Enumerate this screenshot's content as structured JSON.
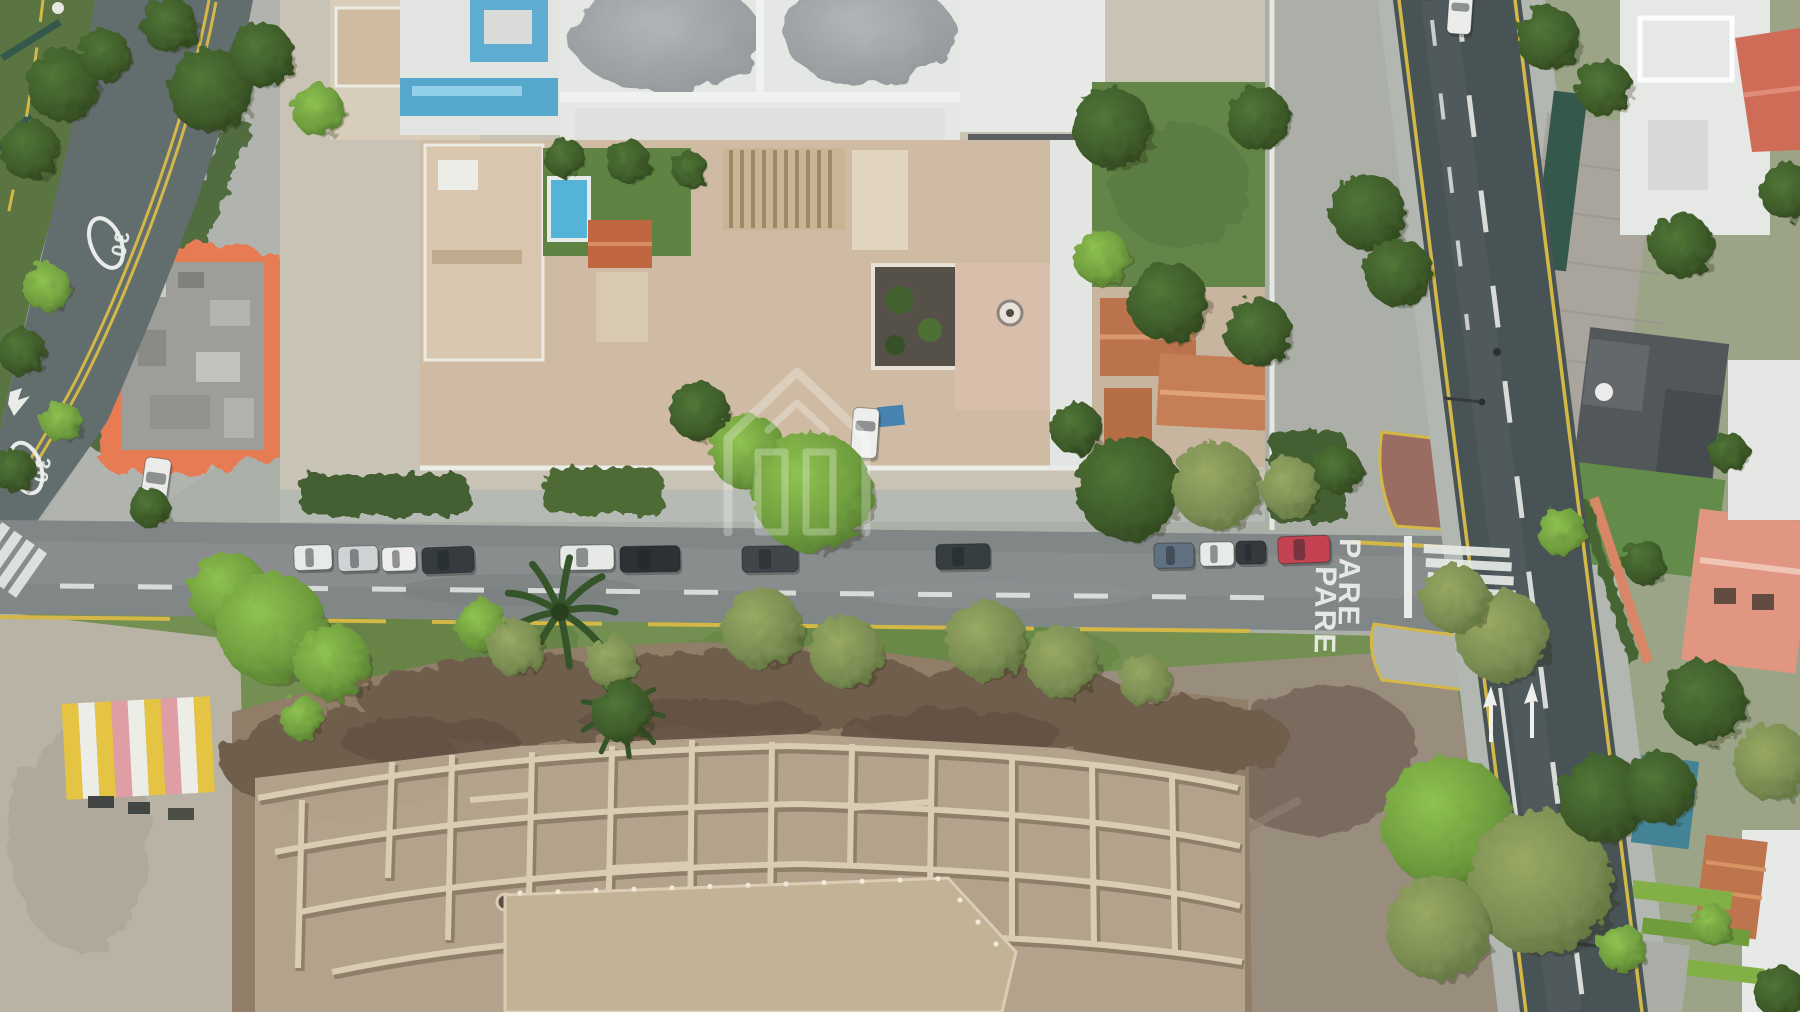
{
  "image": {
    "type": "aerial-drone-photo",
    "subject": "top-down city block with streets, houses, gardens and an excavated archaeological mound"
  },
  "road_markings": {
    "stop_text": "PARE",
    "speed_limit_text": "30"
  },
  "watermark": {
    "icon": "house-logo",
    "color": "#ffffff"
  },
  "palette": {
    "asphalt_dark": "#414c4e",
    "asphalt_mid": "#7d8283",
    "asphalt_blue": "#5c6869",
    "sidewalk": "#b2b6b0",
    "curb_yellow": "#d4b740",
    "marking_white": "#e9ece9",
    "building_orange": "#e0714a",
    "building_blue": "#4fa5cc",
    "roof_beige": "#cfbaa1",
    "roof_terracotta": "#b96e46",
    "lawn_green": "#5d8140",
    "tree_dark": "#2f4f22",
    "tree_bright": "#6fa03a",
    "tree_olive": "#768a4c",
    "huaca_dark": "#6a5845",
    "huaca_light": "#b2a189",
    "plaza": "#b7b1a3",
    "dirt_field": "#96897a",
    "pool_blue": "#4fb2d8"
  },
  "parked_cars": [
    {
      "x": 294,
      "y": 545,
      "w": 38,
      "h": 25,
      "angle": -2,
      "color": "#e9ebe8"
    },
    {
      "x": 338,
      "y": 546,
      "w": 40,
      "h": 25,
      "angle": -2,
      "color": "#ced3d4"
    },
    {
      "x": 382,
      "y": 547,
      "w": 34,
      "h": 24,
      "angle": -2,
      "color": "#f0f1ef"
    },
    {
      "x": 422,
      "y": 547,
      "w": 52,
      "h": 26,
      "angle": -2,
      "color": "#2d3336"
    },
    {
      "x": 560,
      "y": 545,
      "w": 54,
      "h": 25,
      "angle": -1,
      "color": "#e8eae7"
    },
    {
      "x": 620,
      "y": 546,
      "w": 60,
      "h": 26,
      "angle": -1,
      "color": "#24292c"
    },
    {
      "x": 742,
      "y": 546,
      "w": 56,
      "h": 26,
      "angle": -1,
      "color": "#383f42"
    },
    {
      "x": 936,
      "y": 544,
      "w": 54,
      "h": 25,
      "angle": -1,
      "color": "#2f3639"
    },
    {
      "x": 1154,
      "y": 543,
      "w": 40,
      "h": 25,
      "angle": -1,
      "color": "#5a6c7e"
    },
    {
      "x": 1200,
      "y": 542,
      "w": 34,
      "h": 24,
      "angle": -1,
      "color": "#e9ebe9"
    },
    {
      "x": 1236,
      "y": 541,
      "w": 30,
      "h": 23,
      "angle": -1,
      "color": "#2b3134"
    },
    {
      "x": 1278,
      "y": 536,
      "w": 52,
      "h": 27,
      "angle": -2,
      "color": "#c23b4c"
    },
    {
      "x": 1448,
      "y": -8,
      "w": 24,
      "h": 42,
      "angle": 4,
      "color": "#edefed"
    },
    {
      "x": 142,
      "y": 458,
      "w": 26,
      "h": 56,
      "angle": 8,
      "color": "#eceeea"
    },
    {
      "x": 852,
      "y": 408,
      "w": 26,
      "h": 50,
      "angle": 4,
      "color": "#f0f1ee"
    }
  ],
  "trees": [
    [
      62,
      85,
      36,
      "d"
    ],
    [
      30,
      150,
      30,
      "d"
    ],
    [
      105,
      55,
      26,
      "d"
    ],
    [
      170,
      25,
      28,
      "d"
    ],
    [
      210,
      90,
      42,
      "d"
    ],
    [
      262,
      55,
      32,
      "d"
    ],
    [
      318,
      110,
      26,
      "b"
    ],
    [
      48,
      288,
      24,
      "b"
    ],
    [
      22,
      352,
      24,
      "d"
    ],
    [
      62,
      422,
      20,
      "b"
    ],
    [
      14,
      470,
      22,
      "d"
    ],
    [
      150,
      508,
      20,
      "d"
    ],
    [
      565,
      158,
      20,
      "d"
    ],
    [
      628,
      162,
      22,
      "d"
    ],
    [
      690,
      170,
      18,
      "d"
    ],
    [
      1112,
      128,
      40,
      "d"
    ],
    [
      1258,
      118,
      32,
      "d"
    ],
    [
      1102,
      258,
      28,
      "b"
    ],
    [
      1168,
      302,
      40,
      "d"
    ],
    [
      1258,
      332,
      34,
      "d"
    ],
    [
      1076,
      428,
      26,
      "d"
    ],
    [
      1368,
      212,
      38,
      "d"
    ],
    [
      1398,
      272,
      34,
      "d"
    ],
    [
      700,
      412,
      30,
      "d"
    ],
    [
      748,
      452,
      38,
      "b"
    ],
    [
      812,
      492,
      60,
      "b"
    ],
    [
      1128,
      488,
      52,
      "d"
    ],
    [
      1216,
      486,
      44,
      "o"
    ],
    [
      1290,
      487,
      30,
      "o"
    ],
    [
      1338,
      470,
      24,
      "d"
    ],
    [
      228,
      592,
      40,
      "b"
    ],
    [
      272,
      628,
      55,
      "b"
    ],
    [
      332,
      662,
      38,
      "b"
    ],
    [
      482,
      625,
      26,
      "b"
    ],
    [
      516,
      648,
      28,
      "o"
    ],
    [
      612,
      662,
      26,
      "o"
    ],
    [
      762,
      628,
      40,
      "o"
    ],
    [
      846,
      652,
      36,
      "o"
    ],
    [
      986,
      640,
      40,
      "o"
    ],
    [
      1062,
      662,
      36,
      "o"
    ],
    [
      1145,
      680,
      26,
      "o"
    ],
    [
      302,
      718,
      22,
      "b"
    ],
    [
      622,
      712,
      30,
      "d"
    ],
    [
      1502,
      636,
      46,
      "o"
    ],
    [
      1455,
      598,
      34,
      "o"
    ],
    [
      1448,
      822,
      66,
      "b"
    ],
    [
      1540,
      882,
      72,
      "o"
    ],
    [
      1438,
      928,
      52,
      "o"
    ],
    [
      1602,
      798,
      44,
      "d"
    ],
    [
      1660,
      788,
      36,
      "d"
    ],
    [
      1704,
      702,
      42,
      "d"
    ],
    [
      1772,
      762,
      38,
      "o"
    ],
    [
      1548,
      38,
      32,
      "d"
    ],
    [
      1604,
      88,
      28,
      "d"
    ],
    [
      1682,
      246,
      32,
      "d"
    ],
    [
      1788,
      192,
      28,
      "d"
    ],
    [
      1562,
      532,
      24,
      "b"
    ],
    [
      1644,
      562,
      22,
      "d"
    ],
    [
      1728,
      452,
      20,
      "d"
    ],
    [
      1622,
      948,
      24,
      "b"
    ],
    [
      1712,
      925,
      20,
      "b"
    ],
    [
      1780,
      992,
      26,
      "d"
    ]
  ],
  "palms": [
    {
      "x": 560,
      "y": 612,
      "s": 1
    },
    {
      "x": 622,
      "y": 716,
      "s": 0.75
    }
  ],
  "kiosk_stripes": [
    "#e6c23c",
    "#efefe8",
    "#e6c23c",
    "#e09aa2",
    "#efefe8",
    "#e6c23c",
    "#e09aa2",
    "#efefe8",
    "#e6c23c"
  ]
}
